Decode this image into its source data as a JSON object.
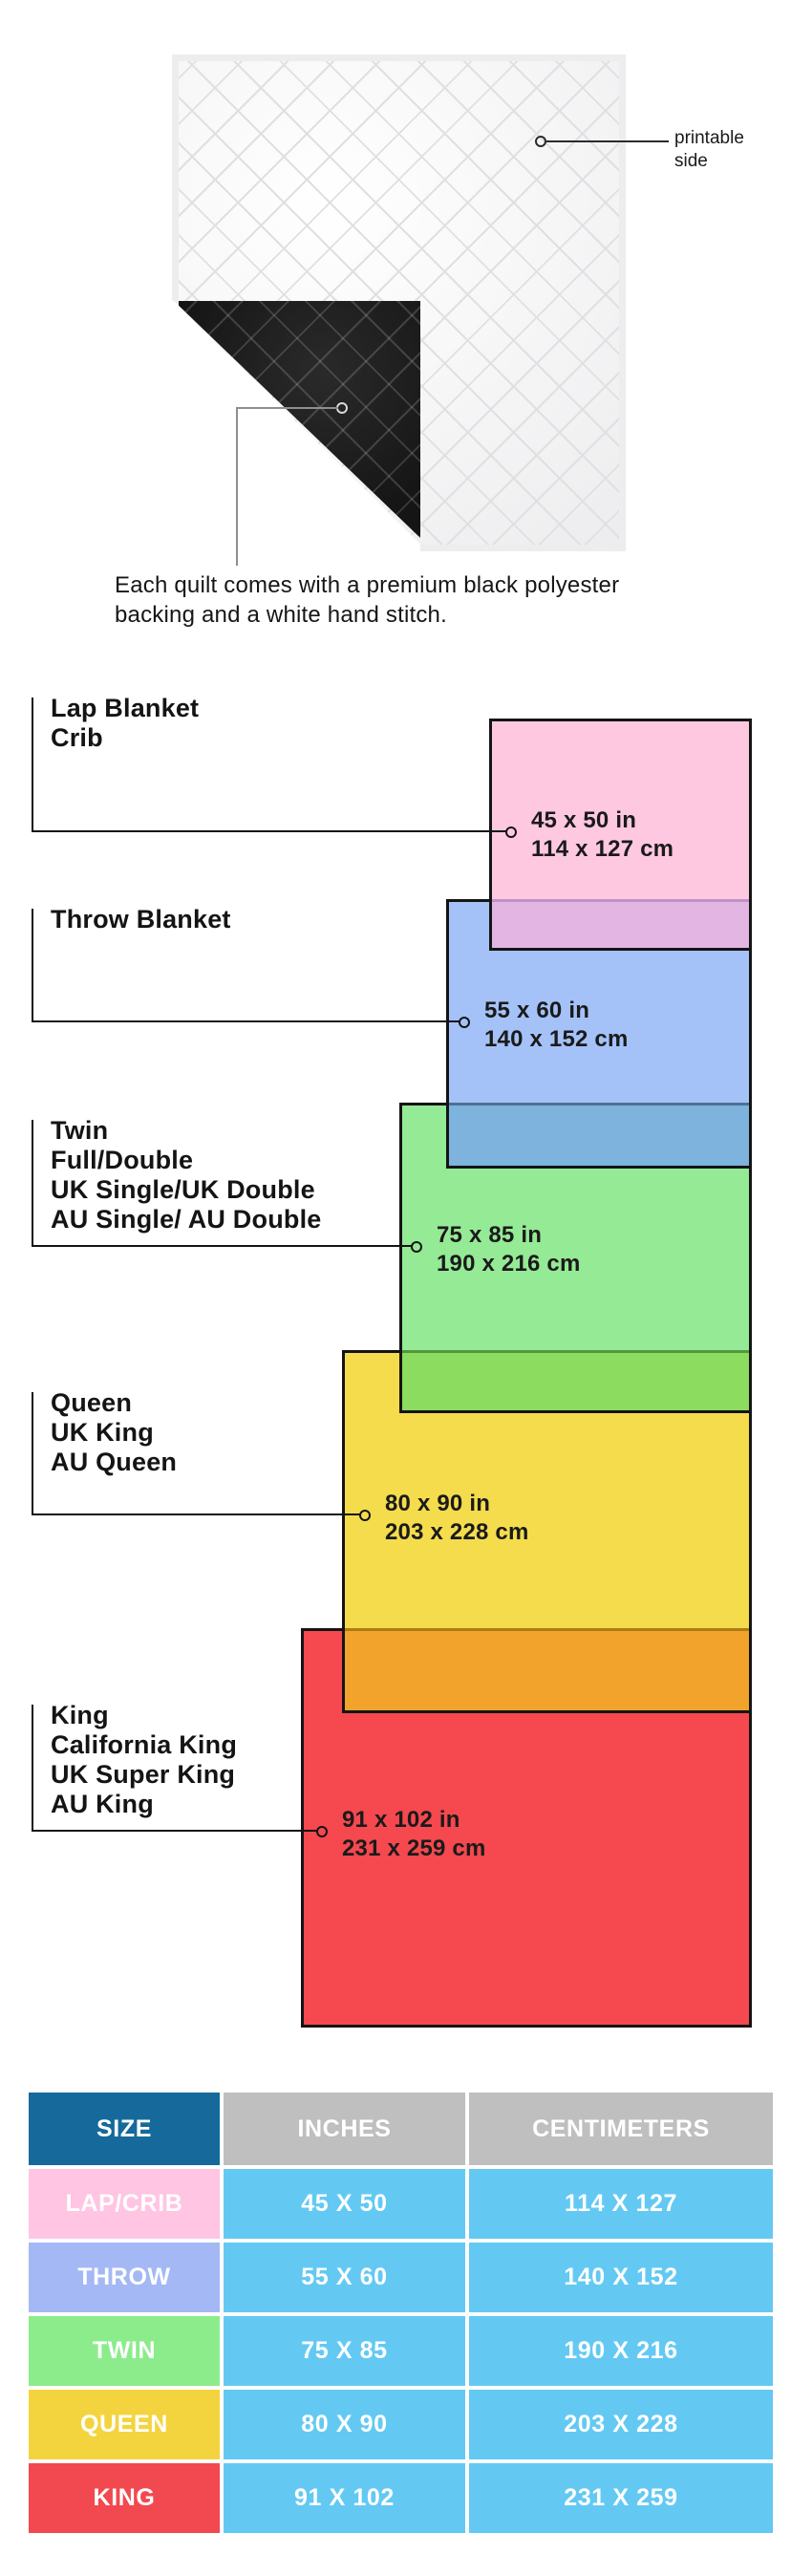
{
  "quilt": {
    "printable_label": "printable side",
    "caption_lines": [
      "Each quilt comes with a premium black polyester",
      "backing and a white hand stitch."
    ]
  },
  "diagram": {
    "groups": [
      {
        "id": "lap",
        "label_lines": [
          "Lap Blanket",
          "Crib"
        ],
        "inches": "45 x 50 in",
        "cm": "114 x 127 cm",
        "fill": "#FFC8E1",
        "overlap_fill": "#E2B5E2"
      },
      {
        "id": "throw",
        "label_lines": [
          "Throw Blanket"
        ],
        "inches": "55 x 60 in",
        "cm": "140 x 152 cm",
        "fill": "#A4C2F8",
        "overlap_fill": "#7DB3DC"
      },
      {
        "id": "twin",
        "label_lines": [
          "Twin",
          "Full/Double",
          "UK Single/UK Double",
          "AU Single/ AU Double"
        ],
        "inches": "75 x 85 in",
        "cm": "190 x 216 cm",
        "fill": "#95EA95",
        "overlap_fill": "#8CDC5F"
      },
      {
        "id": "queen",
        "label_lines": [
          "Queen",
          "UK King",
          "AU Queen"
        ],
        "inches": "80 x 90 in",
        "cm": "203 x 228 cm",
        "fill": "#F4DC4D",
        "overlap_fill": "#F2A32B"
      },
      {
        "id": "king",
        "label_lines": [
          "King",
          "California King",
          "UK Super King",
          "AU King"
        ],
        "inches": "91 x 102 in",
        "cm": "231 x 259 cm",
        "fill": "#F5484F",
        "overlap_fill": null
      }
    ]
  },
  "table": {
    "headers": [
      "SIZE",
      "INCHES",
      "CENTIMETERS"
    ],
    "header_size_bg": "#156A9B",
    "header_gray_bg": "#BFBFBF",
    "value_cell_bg": "#63C9F3",
    "rows": [
      {
        "size": "LAP/CRIB",
        "inches": "45 X 50",
        "centimeters": "114 X 127",
        "label_bg": "#FFC5E3"
      },
      {
        "size": "THROW",
        "inches": "55 X 60",
        "centimeters": "140 X 152",
        "label_bg": "#A4B8F5"
      },
      {
        "size": "TWIN",
        "inches": "75 X 85",
        "centimeters": "190 X 216",
        "label_bg": "#8CEC8C"
      },
      {
        "size": "QUEEN",
        "inches": "80 X 90",
        "centimeters": "203 X 228",
        "label_bg": "#F3D43F"
      },
      {
        "size": "KING",
        "inches": "91 X 102",
        "centimeters": "231 X 259",
        "label_bg": "#F2484F"
      }
    ]
  }
}
